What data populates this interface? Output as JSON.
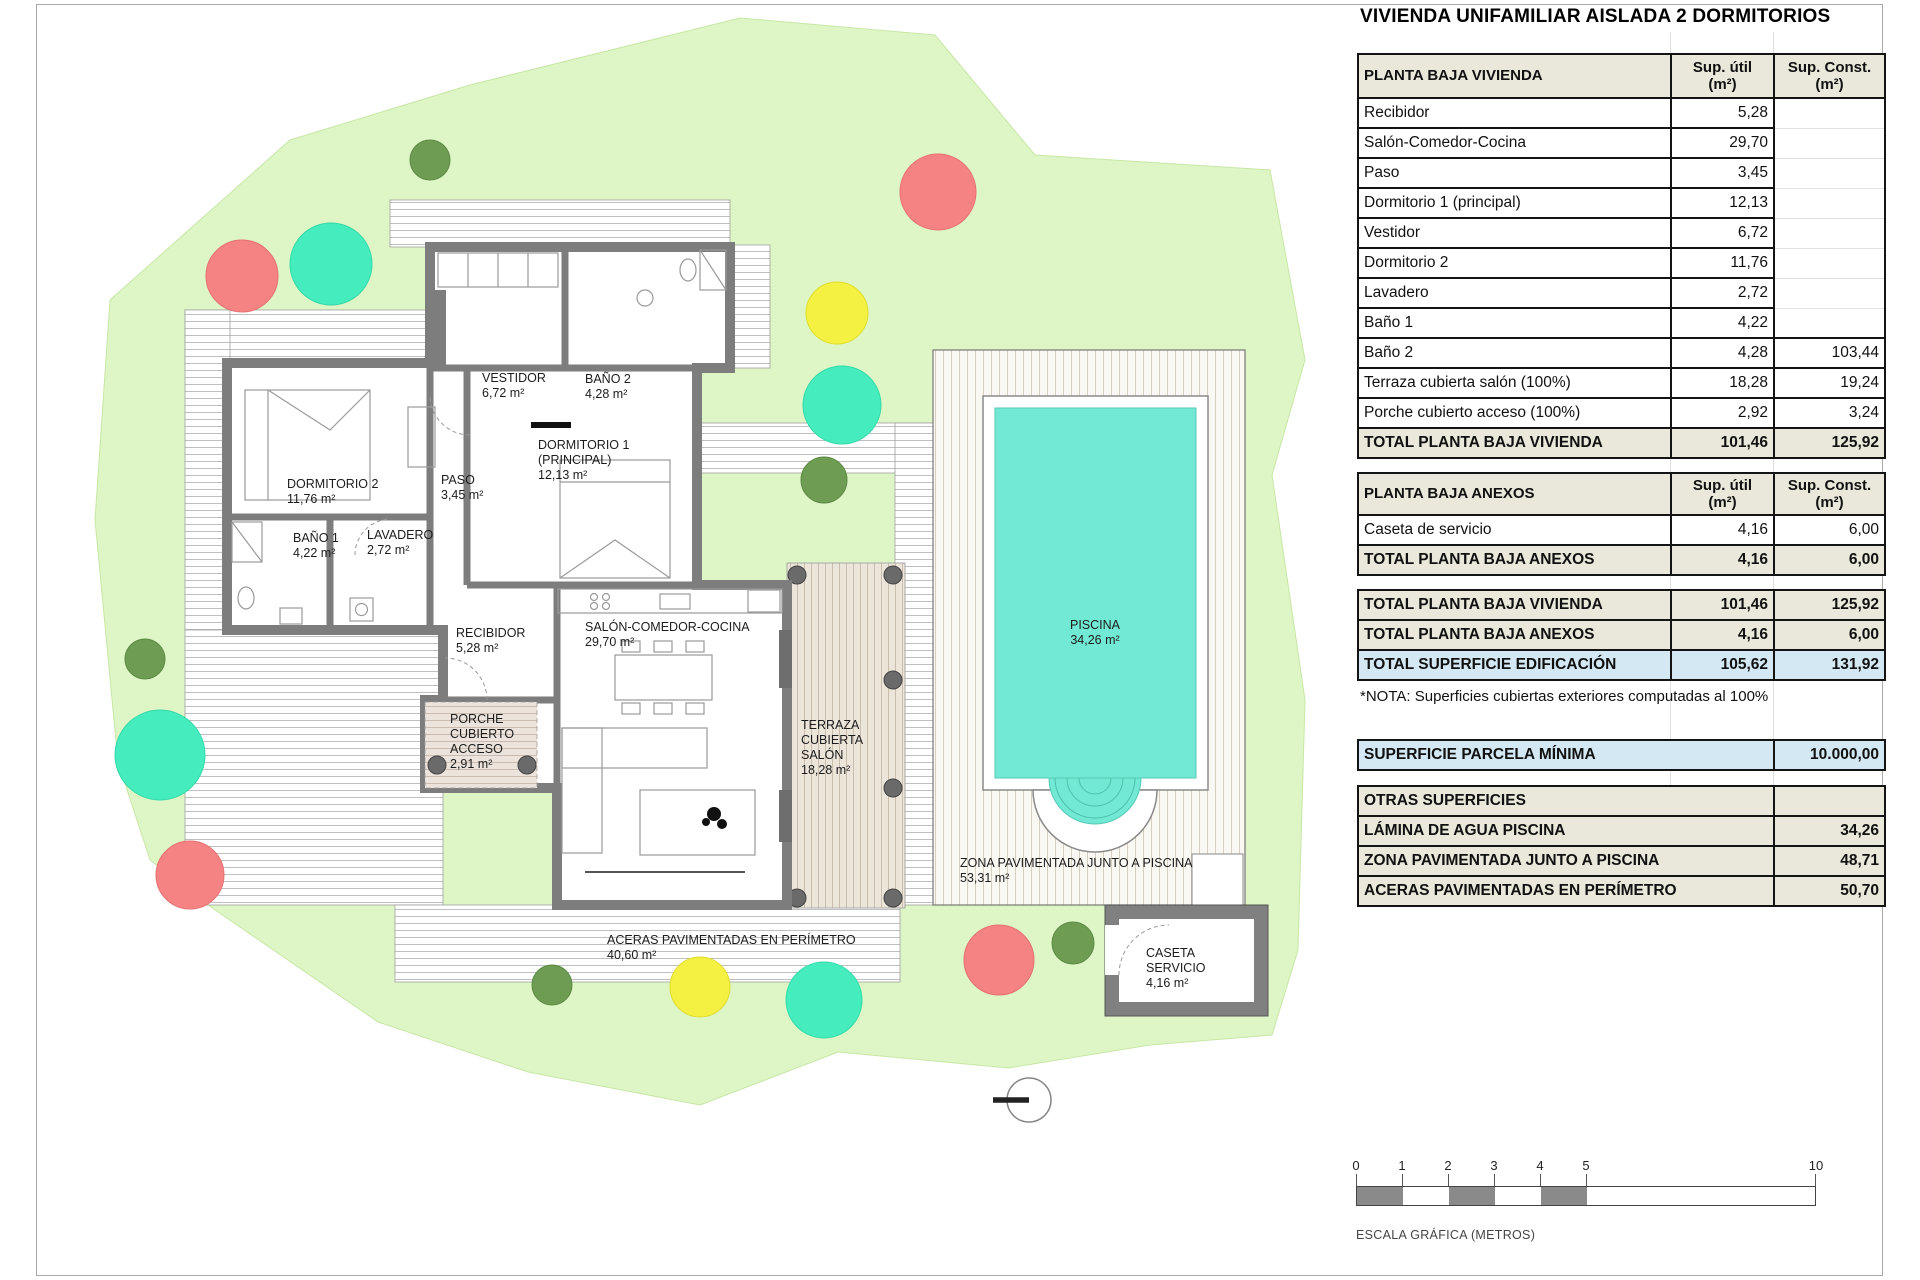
{
  "title": "VIVIENDA UNIFAMILIAR AISLADA 2 DORMITORIOS",
  "tables": {
    "cols": {
      "util": "Sup. útil",
      "const": "Sup. Const.",
      "unit": "(m²)"
    },
    "pbv": {
      "title": "PLANTA BAJA VIVIENDA",
      "rows": [
        [
          "Recibidor",
          "5,28",
          ""
        ],
        [
          "Salón-Comedor-Cocina",
          "29,70",
          ""
        ],
        [
          "Paso",
          "3,45",
          ""
        ],
        [
          "Dormitorio 1 (principal)",
          "12,13",
          ""
        ],
        [
          "Vestidor",
          "6,72",
          ""
        ],
        [
          "Dormitorio 2",
          "11,76",
          ""
        ],
        [
          "Lavadero",
          "2,72",
          ""
        ],
        [
          "Baño 1",
          "4,22",
          ""
        ],
        [
          "Baño 2",
          "4,28",
          "103,44"
        ],
        [
          "Terraza cubierta salón (100%)",
          "18,28",
          "19,24"
        ],
        [
          "Porche cubierto acceso (100%)",
          "2,92",
          "3,24"
        ]
      ],
      "total": {
        "label": "TOTAL PLANTA BAJA VIVIENDA",
        "util": "101,46",
        "const": "125,92"
      }
    },
    "anexos": {
      "title": "PLANTA BAJA ANEXOS",
      "rows": [
        [
          "Caseta de servicio",
          "4,16",
          "6,00"
        ]
      ],
      "total": {
        "label": "TOTAL PLANTA BAJA ANEXOS",
        "util": "4,16",
        "const": "6,00"
      }
    },
    "resumen": {
      "rows": [
        [
          "TOTAL PLANTA BAJA VIVIENDA",
          "101,46",
          "125,92"
        ],
        [
          "TOTAL PLANTA BAJA ANEXOS",
          "4,16",
          "6,00"
        ],
        [
          "TOTAL SUPERFICIE EDIFICACIÓN",
          "105,62",
          "131,92"
        ]
      ]
    },
    "nota": "*NOTA: Superficies cubiertas exteriores computadas al 100%",
    "parcela": {
      "label": "SUPERFICIE PARCELA MÍNIMA",
      "value": "10.000,00"
    },
    "otras": {
      "title": "OTRAS SUPERFICIES",
      "rows": [
        [
          "LÁMINA DE AGUA PISCINA",
          "34,26"
        ],
        [
          "ZONA PAVIMENTADA JUNTO A PISCINA",
          "48,71"
        ],
        [
          "ACERAS PAVIMENTADAS EN PERÍMETRO",
          "50,70"
        ]
      ]
    }
  },
  "plan": {
    "labels": {
      "dormitorio2": {
        "name": "DORMITORIO 2",
        "area": "11,76 m²"
      },
      "bano1": {
        "name": "BAÑO 1",
        "area": "4,22 m²"
      },
      "lavadero": {
        "name": "LAVADERO",
        "area": "2,72 m²"
      },
      "paso": {
        "name": "PASO",
        "area": "3,45 m²"
      },
      "vestidor": {
        "name": "VESTIDOR",
        "area": "6,72 m²"
      },
      "bano2": {
        "name": "BAÑO 2",
        "area": "4,28 m²"
      },
      "dormitorio1": {
        "line1": "DORMITORIO 1",
        "line2": "(PRINCIPAL)",
        "area": "12,13 m²"
      },
      "recibidor": {
        "name": "RECIBIDOR",
        "area": "5,28 m²"
      },
      "salon": {
        "name": "SALÓN-COMEDOR-COCINA",
        "area": "29,70 m²"
      },
      "porche": {
        "line1": "PORCHE",
        "line2": "CUBIERTO",
        "line3": "ACCESO",
        "area": "2,91 m²"
      },
      "terraza": {
        "line1": "TERRAZA",
        "line2": "CUBIERTA",
        "line3": "SALÓN",
        "area": "18,28 m²"
      },
      "piscina": {
        "name": "PISCINA",
        "area": "34,26 m²"
      },
      "zona": {
        "name": "ZONA PAVIMENTADA JUNTO A PISCINA",
        "area": "53,31 m²"
      },
      "aceras": {
        "name": "ACERAS PAVIMENTADAS EN PERÍMETRO",
        "area": "40,60 m²"
      },
      "caseta": {
        "line1": "CASETA",
        "line2": "SERVICIO",
        "area": "4,16 m²"
      }
    }
  },
  "scale_bar": {
    "ticks": [
      "0",
      "1",
      "2",
      "3",
      "4",
      "5",
      "10"
    ],
    "label": "ESCALA GRÁFICA (METROS)"
  },
  "colors": {
    "parcel_green": "#def6c5",
    "pool_water": "#72e9d4",
    "wall_gray": "#7d7d7d",
    "table_header_beige": "#e9e8da",
    "table_total_blue": "#d3e8f2",
    "tree_green": "#6d9c52",
    "tree_red": "#f58383",
    "tree_teal": "#45ecbe",
    "tree_yellow": "#f4f143"
  }
}
